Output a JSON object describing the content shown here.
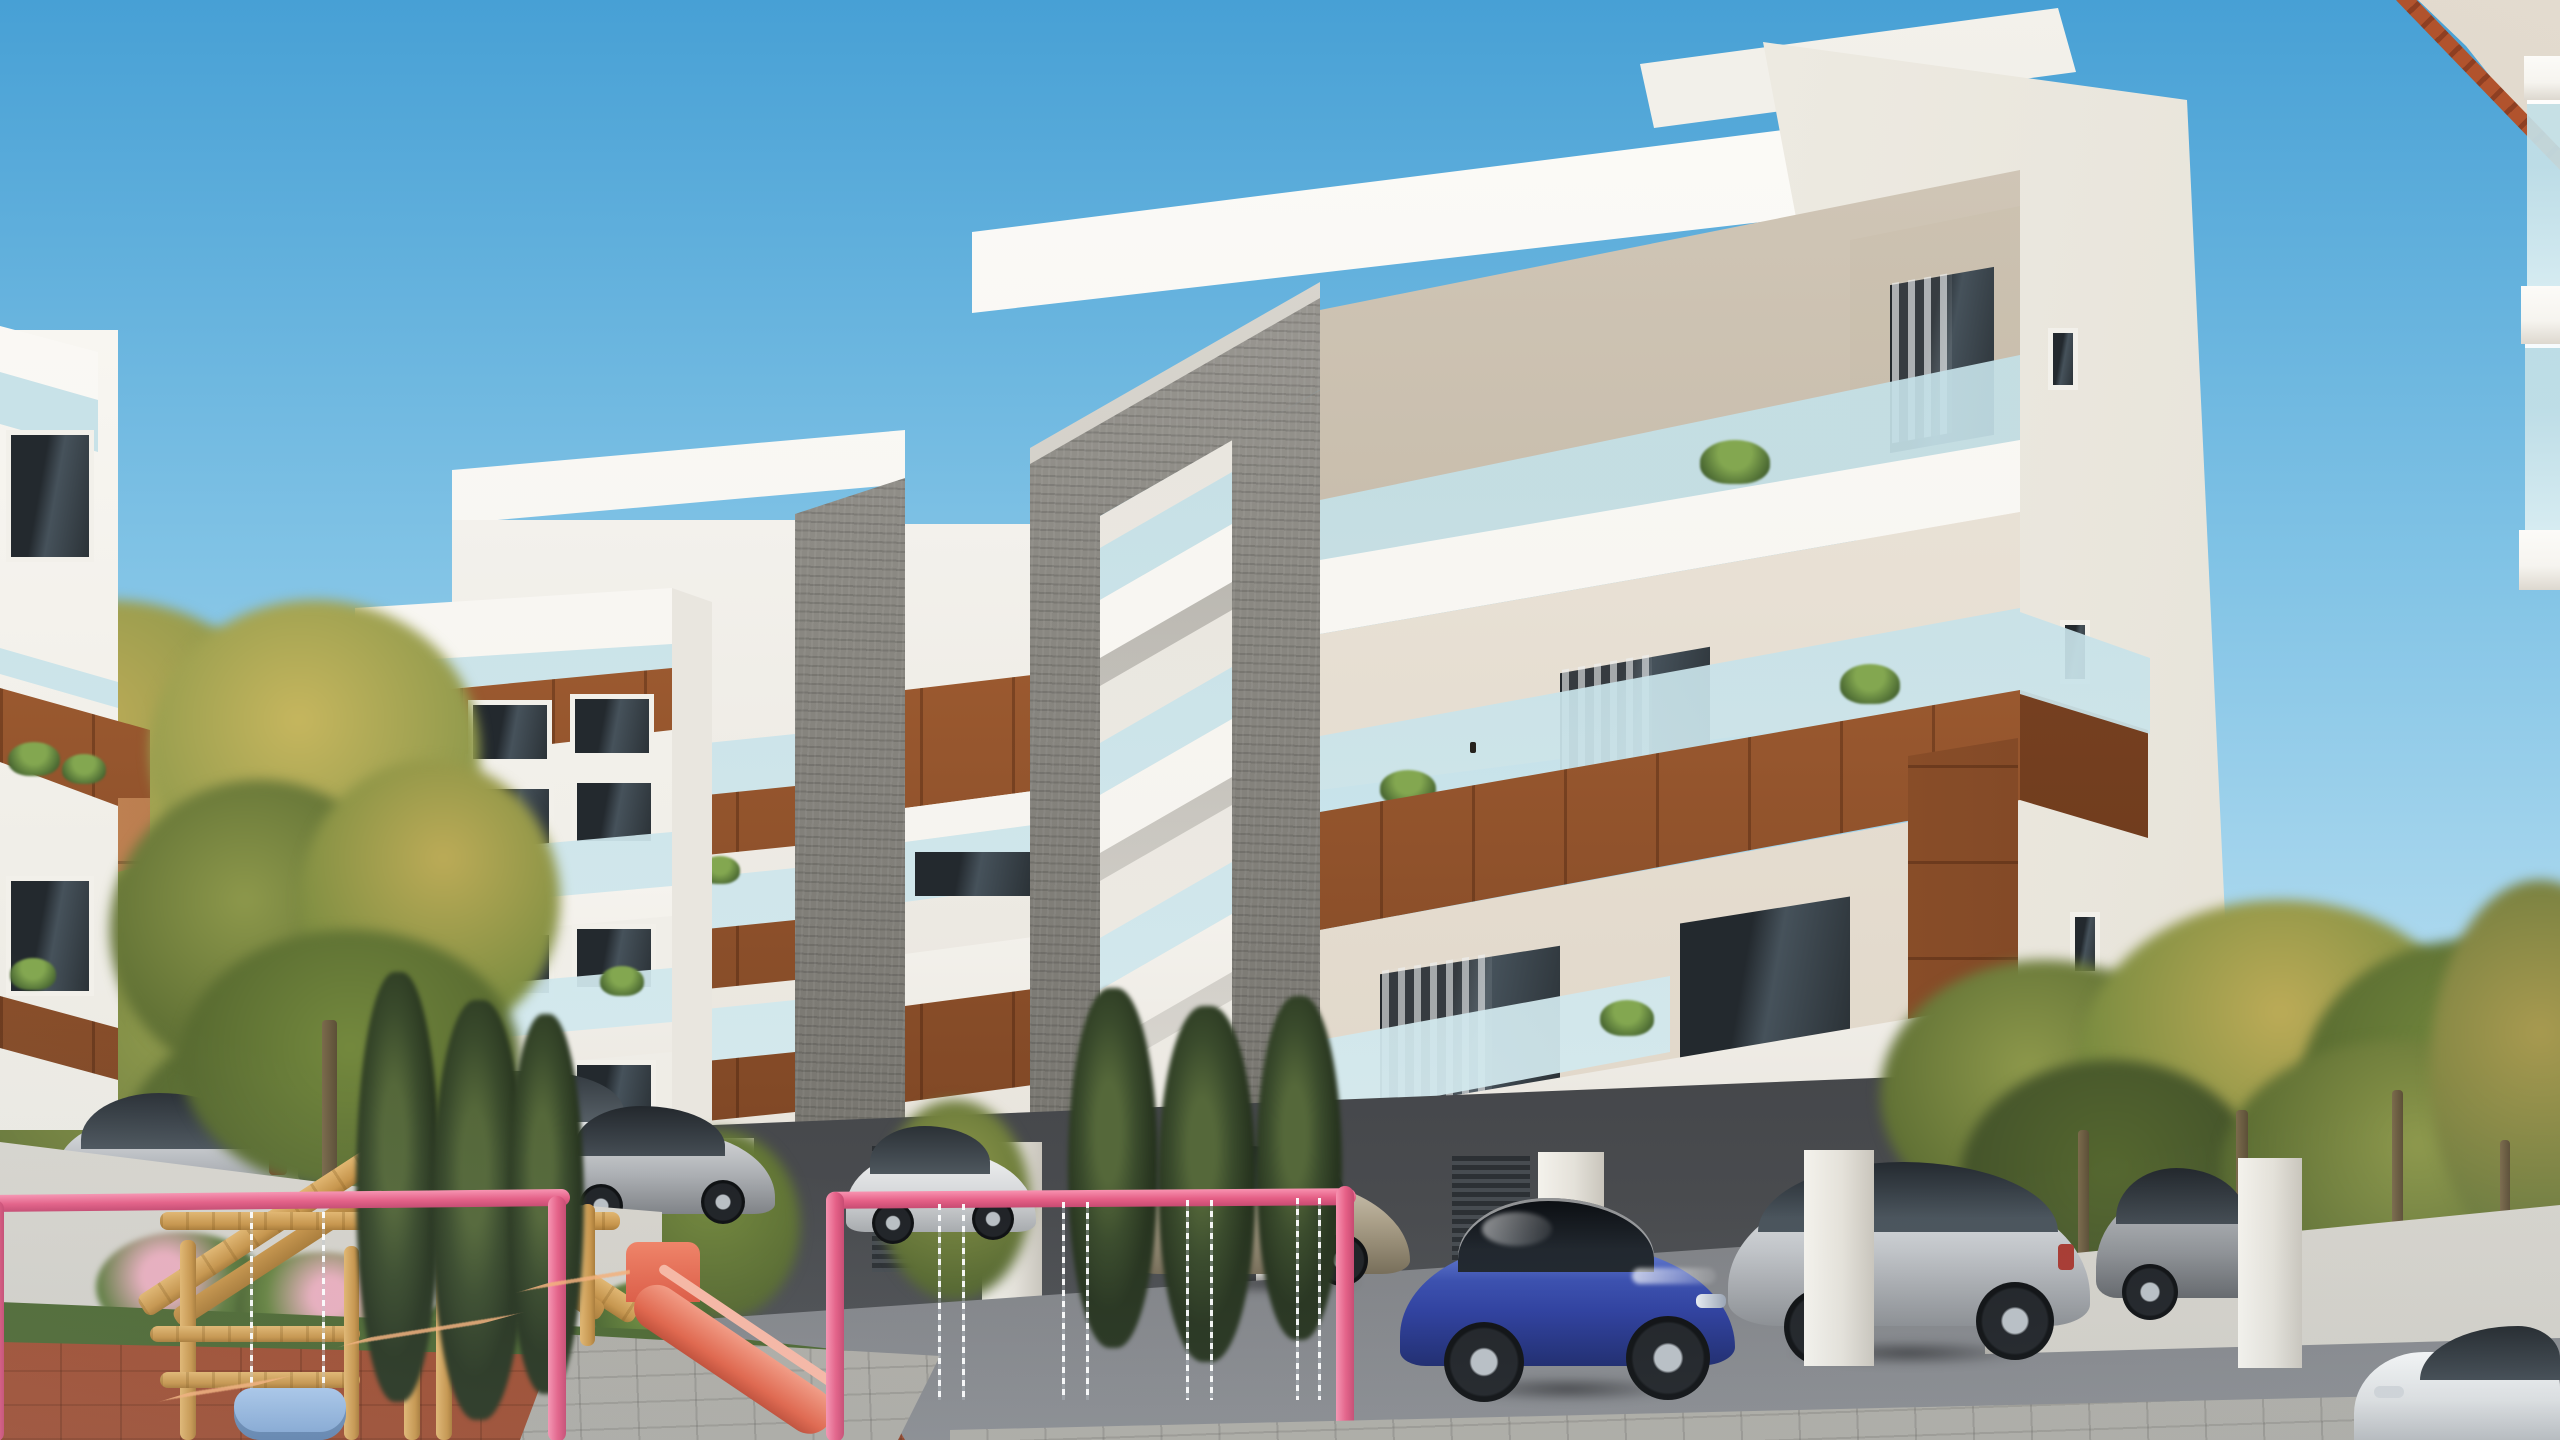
{
  "image": {
    "type": "architectural-exterior-render",
    "width_px": 2560,
    "height_px": 1440
  },
  "scene": {
    "setting": "modern residential apartment complex on a clear sunny day",
    "objects": [
      "sky",
      "main-apartment-building",
      "left-apartment-building",
      "far-left-building-edge",
      "neighbor-roof-top-right",
      "gray-stone-portal-frame",
      "wood-balcony-bands",
      "glass-balustrades",
      "balcony-plants",
      "curtained-windows",
      "pilotis-parking-level",
      "parked-cars",
      "blue-sedan",
      "silver-suv",
      "white-suv",
      "silver-sedans",
      "white-car-bottom-right",
      "asphalt-driveway",
      "paved-walkway",
      "white-garden-wall",
      "flowering-shrubs",
      "lawn",
      "autumn-trees",
      "poplar-trees",
      "playground",
      "wooden-play-house",
      "pink-slide",
      "pink-swing-frame",
      "swing-chains",
      "blue-baby-swing-seat",
      "distant-white-building",
      "white-boundary-fence"
    ],
    "counts": {
      "visible_cars": 11,
      "main_building_visible_floors": 6,
      "swing-chain-pairs": 4
    },
    "palette": {
      "sky-top": "#47a0d5",
      "sky-mid": "#7fc2e5",
      "sky-low": "#b5ddf0",
      "sky-horizon": "#d5eef8",
      "white-lit": "#f8f6f1",
      "white-soft": "#eceae3",
      "white-shade": "#dedad2",
      "ceiling-tan": "#c9bfae",
      "ceiling-deep": "#b2a692",
      "glass-hi": "#e8f4f6",
      "glass-lo": "#c2dde4",
      "wood-light": "#c08354",
      "wood-mid": "#9c5a30",
      "wood-dark": "#6e3c1f",
      "stone-light": "#a8a5a0",
      "stone-mid": "#8b8983",
      "stone-dark": "#6e6c66",
      "stone-top": "#d4d1ca",
      "win-dark": "#262c31",
      "win-mid": "#46525b",
      "curtain": "#e6e8e9",
      "asphalt-hi": "#8a8c90",
      "asphalt-lo": "#515357",
      "shadow-dark": "#2b2d30",
      "paver": "#b9b7b1",
      "lawn": "#6e9244",
      "leaf-gold": "#bcab57",
      "leaf-olive": "#8d984b",
      "leaf-green": "#74893e",
      "leaf-dark": "#55672f",
      "poplar-dark": "#32422a",
      "trunk-brown": "#6f6046",
      "terracotta": "#bb6240",
      "terracotta-dark": "#9d4c30",
      "pink": "#ee6e92",
      "pink-dark": "#cf4d73",
      "blue-car": "#2e3f9e",
      "blue-car-hi": "#6d85d8",
      "silver-hi": "#e4e6e8",
      "silver-lo": "#8b8e92",
      "fence-white": "#e8e6e0",
      "beige-wall": "#dbd2c5",
      "tile-red": "#b1532d",
      "playwood": "#d8ab61",
      "playwood-dark": "#a97a36"
    }
  }
}
